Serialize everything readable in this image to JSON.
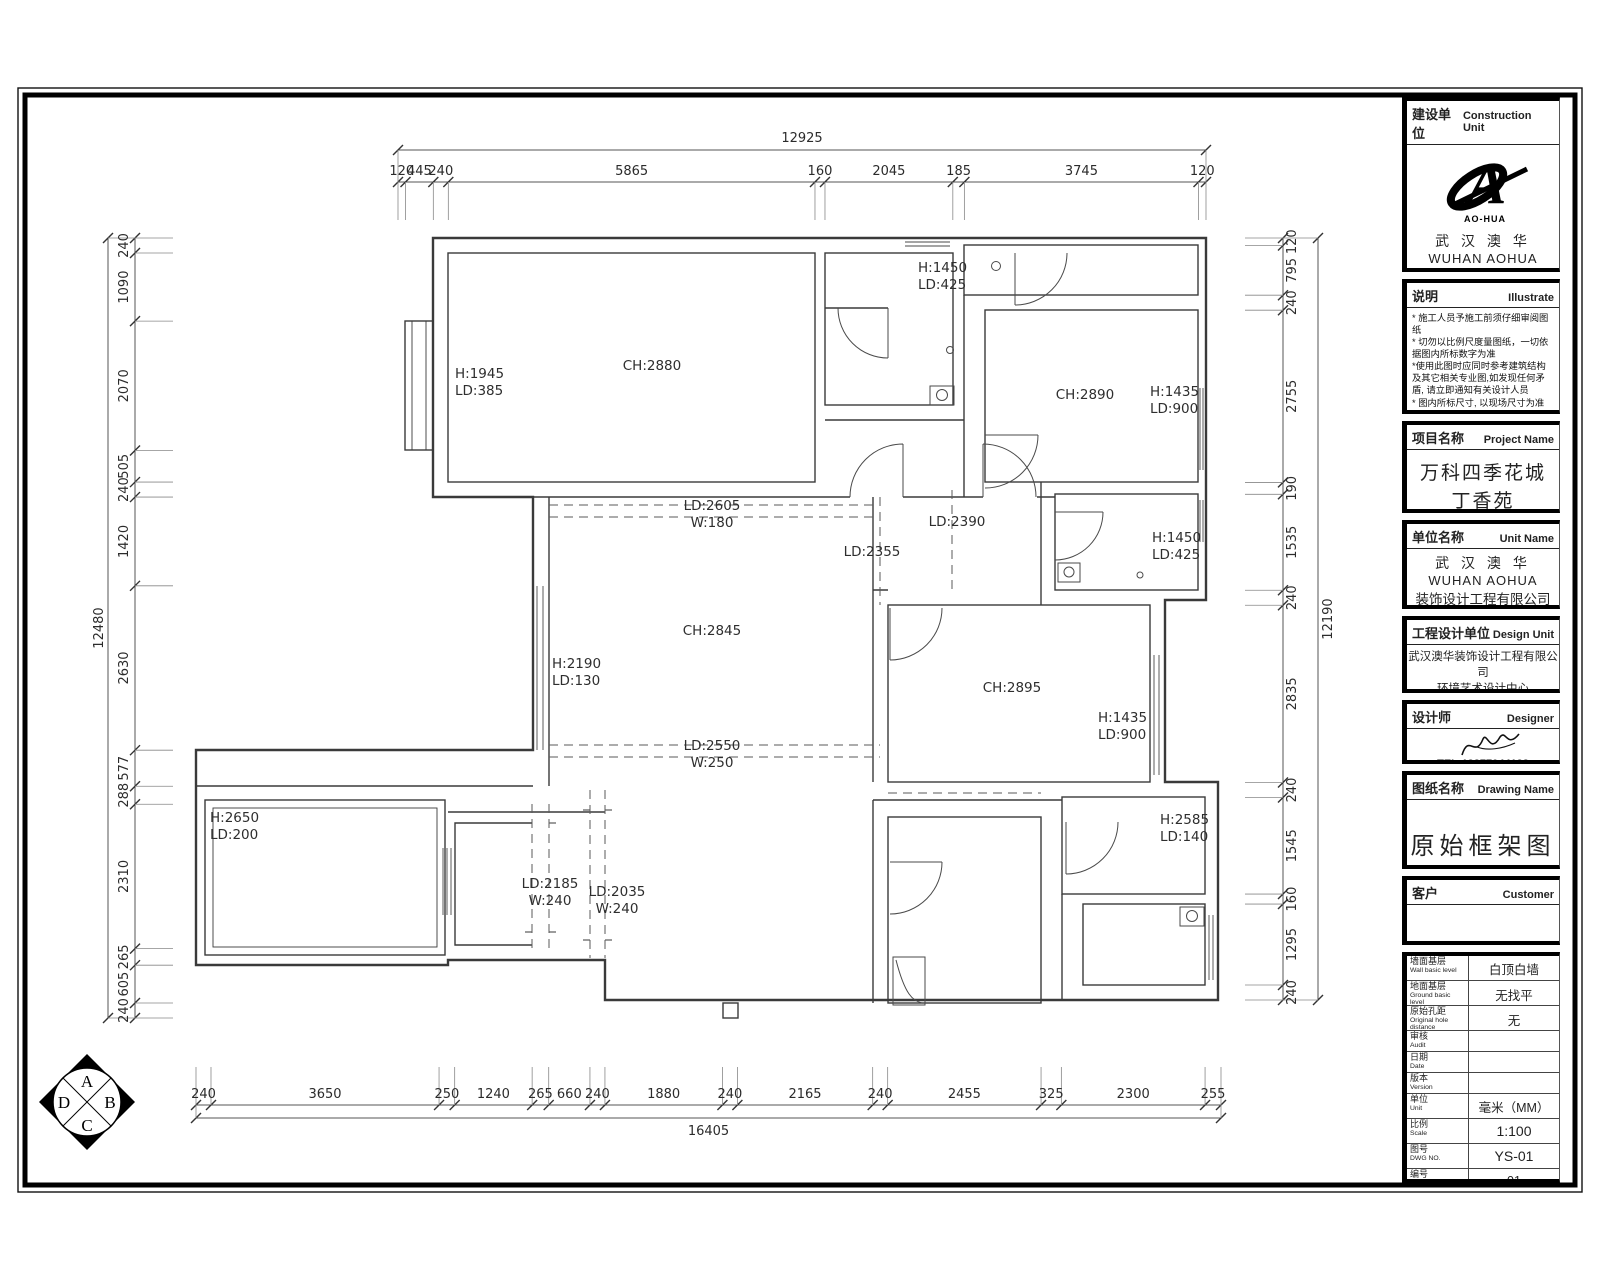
{
  "plan": {
    "room_labels": [
      {
        "lines": [
          "H:1945",
          "LD:385"
        ],
        "x": 455,
        "y": 378,
        "anchor": "start"
      },
      {
        "lines": [
          "CH:2880"
        ],
        "x": 652,
        "y": 370,
        "anchor": "middle"
      },
      {
        "lines": [
          "H:1450",
          "LD:425"
        ],
        "x": 918,
        "y": 272,
        "anchor": "start"
      },
      {
        "lines": [
          "CH:2890"
        ],
        "x": 1085,
        "y": 399,
        "anchor": "middle"
      },
      {
        "lines": [
          "H:1435",
          "LD:900"
        ],
        "x": 1150,
        "y": 396,
        "anchor": "start"
      },
      {
        "lines": [
          "LD:2605",
          "W:180"
        ],
        "x": 712,
        "y": 510,
        "anchor": "middle"
      },
      {
        "lines": [
          "LD:2390"
        ],
        "x": 957,
        "y": 526,
        "anchor": "middle"
      },
      {
        "lines": [
          "LD:2355"
        ],
        "x": 872,
        "y": 556,
        "anchor": "middle"
      },
      {
        "lines": [
          "H:1450",
          "LD:425"
        ],
        "x": 1152,
        "y": 542,
        "anchor": "start"
      },
      {
        "lines": [
          "CH:2845"
        ],
        "x": 712,
        "y": 635,
        "anchor": "middle"
      },
      {
        "lines": [
          "H:2190",
          "LD:130"
        ],
        "x": 552,
        "y": 668,
        "anchor": "start"
      },
      {
        "lines": [
          "CH:2895"
        ],
        "x": 1012,
        "y": 692,
        "anchor": "middle"
      },
      {
        "lines": [
          "H:1435",
          "LD:900"
        ],
        "x": 1098,
        "y": 722,
        "anchor": "start"
      },
      {
        "lines": [
          "LD:2550",
          "W:250"
        ],
        "x": 712,
        "y": 750,
        "anchor": "middle"
      },
      {
        "lines": [
          "H:2650",
          "LD:200"
        ],
        "x": 210,
        "y": 822,
        "anchor": "start"
      },
      {
        "lines": [
          "LD:2185",
          "W:240"
        ],
        "x": 550,
        "y": 888,
        "anchor": "middle"
      },
      {
        "lines": [
          "LD:2035",
          "W:240"
        ],
        "x": 617,
        "y": 896,
        "anchor": "middle"
      },
      {
        "lines": [
          "H:2585",
          "LD:140"
        ],
        "x": 1160,
        "y": 824,
        "anchor": "start"
      }
    ],
    "compass": {
      "top": "A",
      "right": "B",
      "bottom": "C",
      "left": "D"
    }
  },
  "dimensions": {
    "top": {
      "total": "12925",
      "segments": [
        "120",
        "445",
        "240",
        "5865",
        "160",
        "2045",
        "185",
        "3745",
        "120"
      ]
    },
    "bottom": {
      "total": "16405",
      "segments": [
        "240",
        "3650",
        "250",
        "1240",
        "265",
        "660",
        "240",
        "1880",
        "240",
        "2165",
        "240",
        "2455",
        "325",
        "2300",
        "255"
      ]
    },
    "left": {
      "total": "12480",
      "segments": [
        "240",
        "1090",
        "2070",
        "505",
        "240",
        "1420",
        "2630",
        "577",
        "288",
        "2310",
        "265",
        "605",
        "240"
      ]
    },
    "right": {
      "total": "12190",
      "segments": [
        "120",
        "795",
        "240",
        "2755",
        "190",
        "1535",
        "240",
        "2835",
        "240",
        "1545",
        "160",
        "1295",
        "240"
      ]
    }
  },
  "title_block": {
    "construction_unit": {
      "label_cn": "建设单位",
      "label_en": "Construction Unit",
      "logo_text": "AO-HUA",
      "company_cn1": "武 汉 澳 华",
      "company_en1": "WUHAN AOHUA",
      "company_cn2": "装饰设计工程有限公司",
      "company_en2": "Decoration Design Engineering Co.,Ltd"
    },
    "illustrate": {
      "label_cn": "说明",
      "label_en": "Illustrate",
      "lines": [
        "* 施工人员予施工前须仔细审阅图纸",
        "* 切勿以比例尺度量图纸，一切依据图内所标数字为准",
        "*使用此图时应同时参考建筑结构及其它相关专业图,如发现任何矛盾, 请立即通知有关设计人员",
        "* 图内所标尺寸, 以现场尺寸为准",
        "* 建筑结构以设计院建筑结构图为准",
        "*未加盖本公司设计图章不准在施工中使用"
      ]
    },
    "project_name": {
      "label_cn": "项目名称",
      "label_en": "Project Name",
      "line1": "万科四季花城",
      "line2": "丁香苑"
    },
    "unit_name": {
      "label_cn": "单位名称",
      "label_en": "Unit Name",
      "company_cn1": "武 汉 澳 华",
      "company_en1": "WUHAN AOHUA",
      "company_cn2": "装饰设计工程有限公司",
      "company_en2": "Decoration Design Engineering Co.,Ltd"
    },
    "design_unit": {
      "label_cn": "工程设计单位",
      "label_en": "Design Unit",
      "line1": "武汉澳华装饰设计工程有限公司",
      "line2": "环境艺术设计中心",
      "line3": "WUHAN AOHUA Decoration Design Engineering Co.,Ltd",
      "line4": "Environmental Art Design Center"
    },
    "designer": {
      "label_cn": "设计师",
      "label_en": "Designer",
      "tel": "TEL:13277044133"
    },
    "drawing_name": {
      "label_cn": "图纸名称",
      "label_en": "Drawing Name",
      "value": "原始框架图"
    },
    "customer": {
      "label_cn": "客户",
      "label_en": "Customer",
      "value": ""
    },
    "info_rows": [
      {
        "cn": "墙面基层",
        "en": "Wall basic level",
        "value": "白顶白墙"
      },
      {
        "cn": "地面基层",
        "en": "Ground basic level",
        "value": "无找平"
      },
      {
        "cn": "原始孔距",
        "en": "Original hole distance",
        "value": "无"
      },
      {
        "cn": "审核",
        "en": "Audit",
        "value": ""
      },
      {
        "cn": "日期",
        "en": "Date",
        "value": ""
      },
      {
        "cn": "版本",
        "en": "Version",
        "value": ""
      },
      {
        "cn": "单位",
        "en": "Unit",
        "value": "毫米（MM）"
      },
      {
        "cn": "比例",
        "en": "Scale",
        "value": "1:100"
      },
      {
        "cn": "图号",
        "en": "DWG NO.",
        "value": "YS-01"
      },
      {
        "cn": "编号",
        "en": "NO.",
        "value": "01"
      }
    ]
  }
}
